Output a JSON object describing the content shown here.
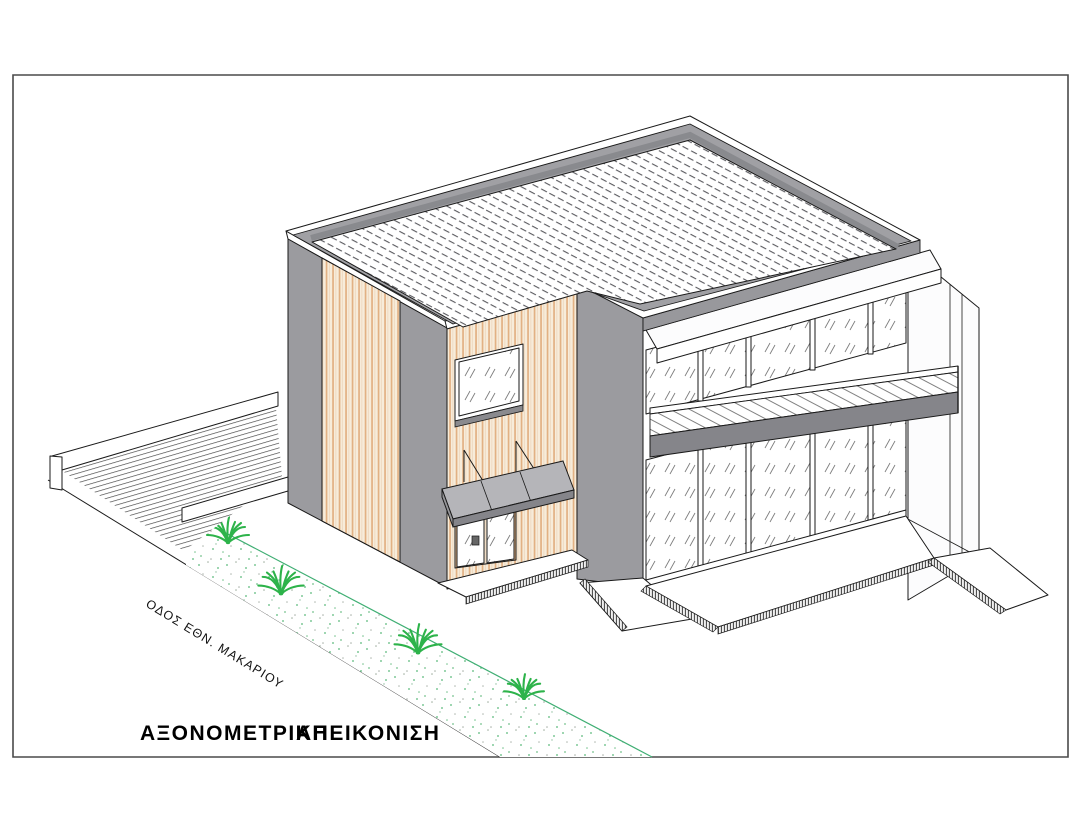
{
  "drawing": {
    "title_word1": "ΑΞΟΝΟΜΕΤΡΙΚΗ",
    "title_word2": "ΑΠΕΙΚΟΝΙΣΗ",
    "street_label": "ΟΔΟΣ ΕΘΝ. ΜΑΚΑΡΙΟΥ"
  },
  "palette": {
    "wall_gray": "#9b9b9f",
    "parapet_gray": "#a0a0a4",
    "parapet_face": "#98989c",
    "canopy_gray": "#b5b5b9",
    "canopy_cap": "#97979b",
    "fascia_dark": "#85858a",
    "sill_gray": "#8a8a8e",
    "wood_base": "#f7ecda",
    "wood_stripe": "#e2b183",
    "wood_stripe_light": "#eed8bf",
    "plant_green": "#2db34a",
    "strip_line_green": "#3fae73",
    "line_black": "#1a1a1a"
  }
}
